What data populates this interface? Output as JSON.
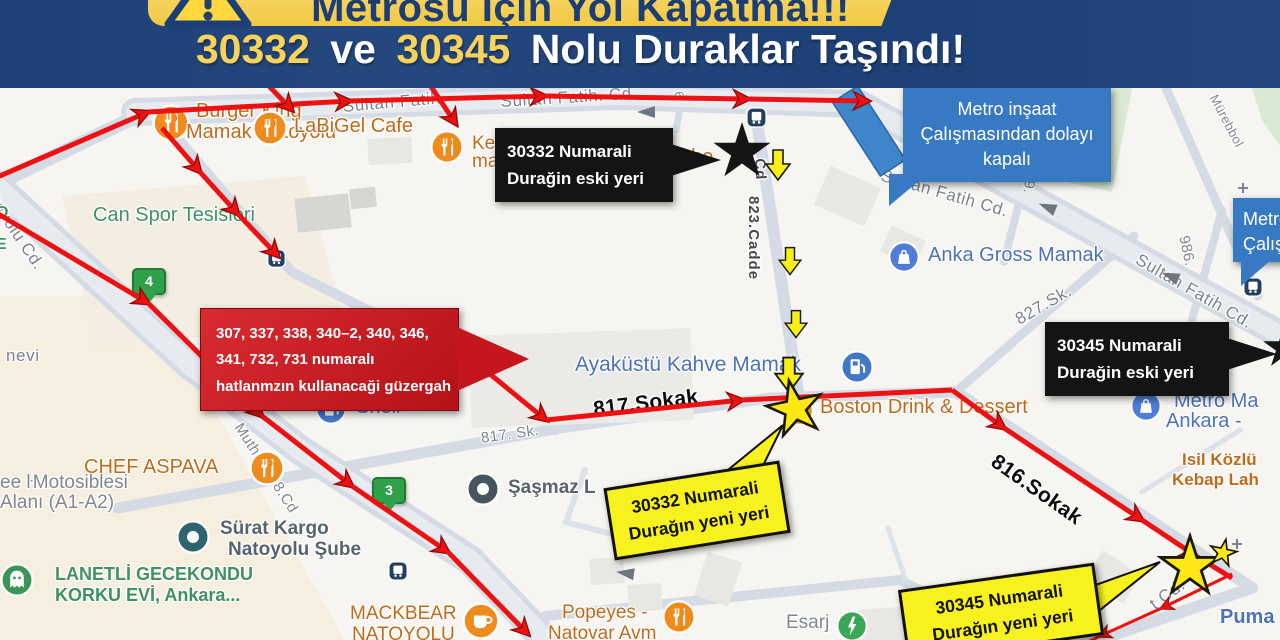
{
  "header": {
    "banner_title": "Metrosu İçin Yol Kapatma!!!",
    "subtitle": {
      "num1": "30332",
      "conj": "ve",
      "num2": "30345",
      "rest": "Nolu Duraklar Taşındı!"
    }
  },
  "callouts": {
    "old_30332": {
      "line1": "30332 Numarali",
      "line2": "Durağin eski yeri"
    },
    "old_30345": {
      "line1": "30345 Numarali",
      "line2": "Durağin eski yeri"
    },
    "new_30332": {
      "line1": "30332 Numarali",
      "line2": "Durağın yeni yeri"
    },
    "new_30345": {
      "line1": "30345 Numarali",
      "line2": "Durağın yeni yeri"
    },
    "closure": {
      "line1": "Metro inşaat",
      "line2": "Çalışmasından dolayı",
      "line3": "kapalı"
    },
    "closure_right": {
      "line1": "Metro",
      "line2": "Çalışı"
    },
    "route_info": {
      "line1": "307, 337, 338, 340–2, 340, 346,",
      "line2": "341, 732, 731 numaralı",
      "line3": "hatlanmzın kullanacaği güzergah"
    }
  },
  "map": {
    "streets": {
      "sultan_main": "Sultan Fatih. Cd.",
      "sultan_left": "Sultan Fatih",
      "sultan_mid": "Sultan Fatih Cd.",
      "sultan_right": "Sultan Fatih Cd.",
      "cadde823": "823.Cadde",
      "cadde823_cd": "Cd",
      "sk827": "827.Sk.",
      "sk817_gray": "817. Sk.",
      "sk817_black": "817.Sokak",
      "sk816_black": "816.Sokak",
      "muthubat": "Muthubat 8.Cd",
      "latgyolu": "latgyolu Cd.",
      "nevi": "nevi",
      "t_cd": "t Cd.",
      "n986": "986.",
      "n169": "169.",
      "murebbol": "Mürebbol",
      "n6": "6"
    },
    "pois": {
      "burger_1": "Burger King",
      "burger_2": "Mamak Natoyolu",
      "labigel": "LaBiGel Cafe",
      "kebab_1": "Ke",
      "kebab_2": "ma",
      "sube": "şube",
      "can_spor": "Can Spor Tesisleri",
      "anka": "Anka Gross Mamak",
      "ayakustu": "Ayaküstü Kahve Mamak",
      "shell": "Shell",
      "sasmaz": "Şaşmaz L",
      "chef": "CHEF ASPAVA",
      "moto_1": "ee ŀMotosiblesi",
      "moto_2": "Alanı (A1-A2)",
      "surat_1": "Sürat Kargo",
      "surat_2": "Natoyolu Şube",
      "lanetli_1": "LANETLİ GECEKONDU",
      "lanetli_2": "KORKU EVİ, Ankara...",
      "mackbear_1": "MACKBEAR",
      "mackbear_2": "NATOYOLU",
      "popeyes_1": "Popeyes -",
      "popeyes_2": "Natovar Avm",
      "esarj": "Esarj",
      "boston": "Boston Drink & Dessert",
      "isil_1": "Isil Közlü",
      "isil_2": "Kebap Lah",
      "metro_1": "Metro Ma",
      "metro_2": "Ankara - ",
      "puma": "Puma",
      "green_o": "O",
      "green_e": "E"
    },
    "pins": {
      "a": "4",
      "b": "3"
    }
  },
  "colors": {
    "header_bg": "#20457c",
    "banner_yellow": "#f5cf4c",
    "accent_yellow": "#f7d35b",
    "route_red": "#ee1111",
    "callout_black": "#141414",
    "callout_blue": "#3879c3",
    "callout_red": "#c4161c",
    "callout_yellow": "#f7f21d",
    "poi_orange": "#bf6a1a",
    "poi_blue": "#4b72ba",
    "poi_green": "#3f9160",
    "street_gray": "#80868f",
    "star_yellow": "#ffe715"
  }
}
